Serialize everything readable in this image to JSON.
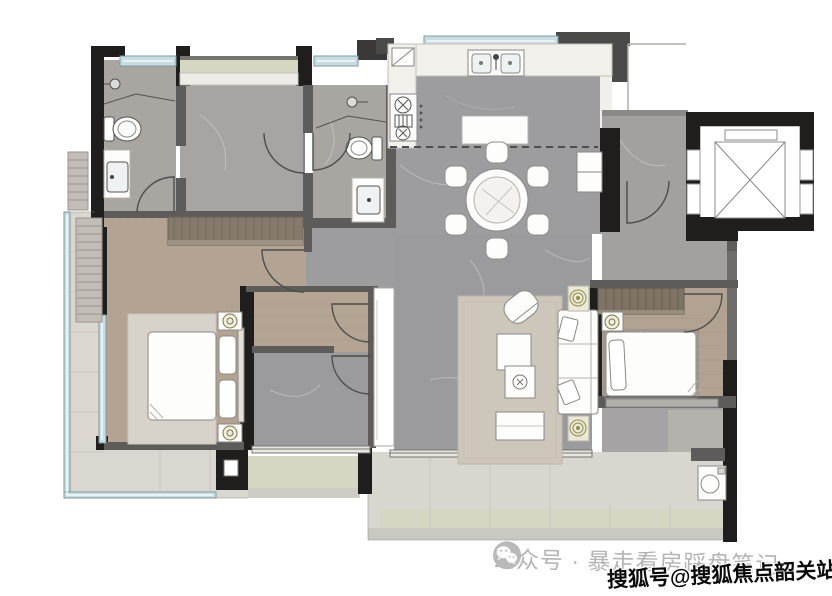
{
  "canvas": {
    "width": 832,
    "height": 596,
    "background": "#ffffff"
  },
  "watermarks": {
    "wechat": {
      "icon": "wechat-icon",
      "text": "公众号 · 暴走看房踩盘笔记",
      "color": "#b4b4b4"
    },
    "sohu": {
      "text": "搜狐号@搜狐焦点韶关站",
      "color": "#0a0a0a",
      "outline": "#ffffff"
    }
  },
  "floorplan": {
    "type": "residential-apartment-floor-plan",
    "rooms": [
      "master-bathroom",
      "walk-in-dressing-room",
      "second-bathroom",
      "kitchen",
      "dining-area",
      "entry-foyer",
      "elevator-shaft",
      "hallway",
      "master-bedroom",
      "middle-room",
      "living-room",
      "second-bedroom",
      "laundry-nook",
      "side-balcony",
      "main-balcony"
    ],
    "furniture_icons": [
      "shower-head-icon",
      "toilet-icon",
      "vanity-sink-icon",
      "double-kitchen-sink-icon",
      "gas-stove-icon",
      "fridge-icon",
      "kitchen-island",
      "round-dining-table-6-chairs",
      "shoe-cabinet",
      "sofa",
      "armchair",
      "coffee-tables",
      "tv-console",
      "plant-pot-icon",
      "double-bed",
      "nightstand-lamp-icon",
      "wardrobe",
      "single-bed",
      "washing-machine-icon",
      "elevator-x-symbol"
    ],
    "palette": {
      "wall_black": "#1f1e1d",
      "wall_gray": "#5d5c5a",
      "marble_floor": "#9d9da0",
      "wood_floor": "#b3a392",
      "counter_white": "#f1efea",
      "balcony_floor": "#d9d5cf",
      "planter_green": "#d5d7c2",
      "window_glass": "#c7dde1",
      "rug": "#cdc6ba",
      "wardrobe_wood": "#7e7365"
    }
  }
}
